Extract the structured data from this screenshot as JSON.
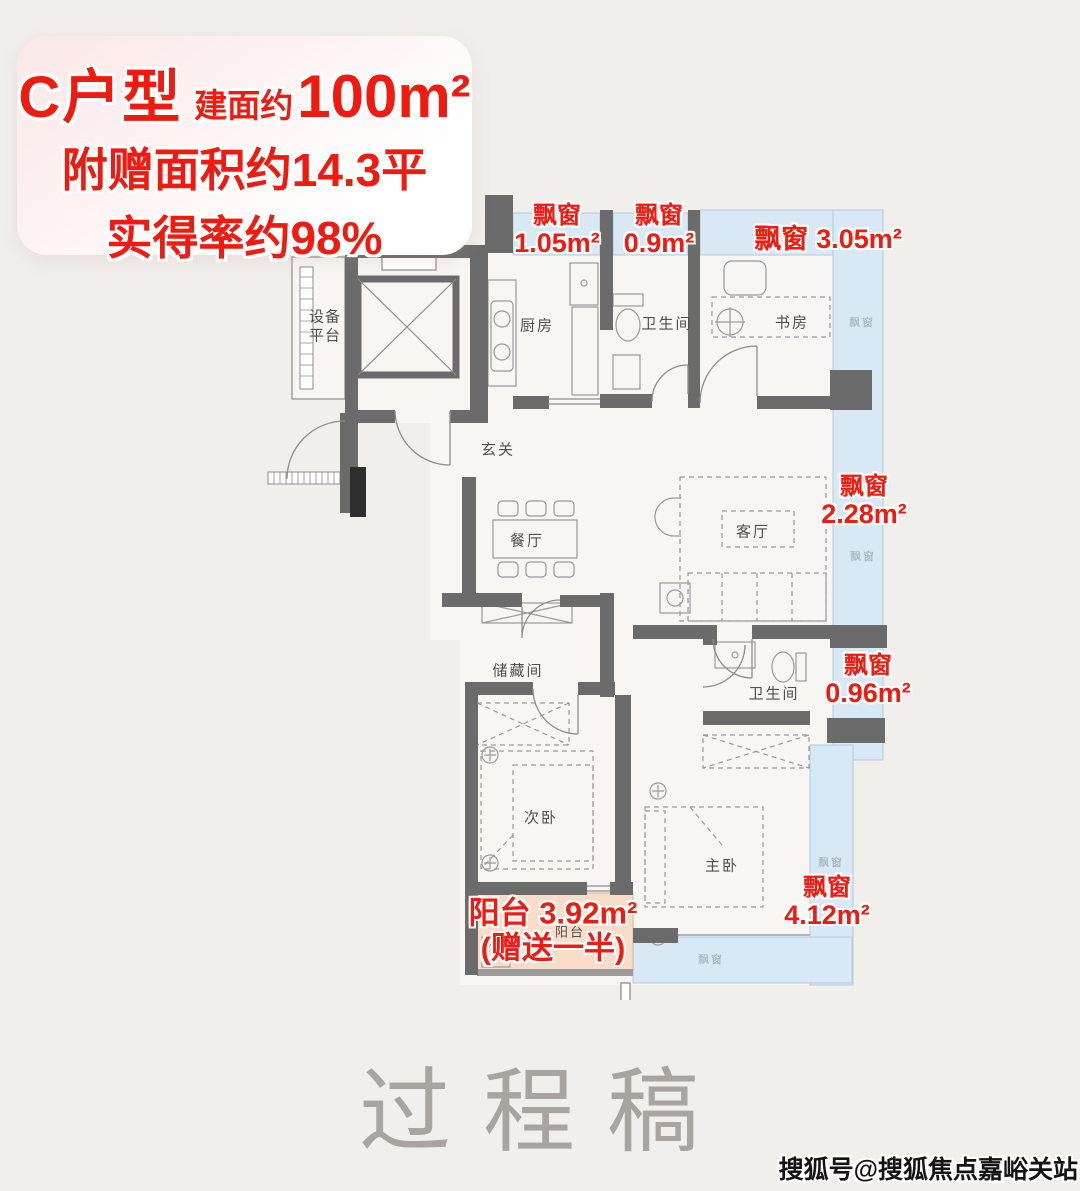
{
  "title_card": {
    "unit": "C户型",
    "area_label": "建面约",
    "area_value": "100m²",
    "bonus_line": "附赠面积约14.3平",
    "rate_line": "实得率约98%"
  },
  "bay_windows": [
    {
      "label": "飘窗",
      "area": "1.05m²"
    },
    {
      "label": "飘窗",
      "area": "0.9m²"
    },
    {
      "label": "飘窗",
      "area": "3.05m²"
    },
    {
      "label": "飘窗",
      "area": "2.28m²"
    },
    {
      "label": "飘窗",
      "area": "0.96m²"
    },
    {
      "label": "飘窗",
      "area": "4.12m²"
    }
  ],
  "balcony_note": {
    "line1": "阳台 3.92m²",
    "line2": "(赠送一半)"
  },
  "rooms": {
    "equipment_platform_1": "设备",
    "equipment_platform_2": "平台",
    "kitchen": "厨房",
    "bathroom_top": "卫生间",
    "study": "书房",
    "foyer": "玄关",
    "dining": "餐厅",
    "living": "客厅",
    "storage": "储藏间",
    "bathroom_bottom": "卫生间",
    "second_bedroom": "次卧",
    "master_bedroom": "主卧",
    "balcony": "阳台",
    "bay_window": "飘窗"
  },
  "watermark": "过程稿",
  "credit": "搜狐号@搜狐焦点嘉峪关站",
  "colors": {
    "accent_red": "#ee1b11",
    "bay_window_blue": "#d8e8f4",
    "balcony_orange": "#f9ddc8",
    "wall_gray": "#6b6b6b",
    "background": "#f1efec"
  }
}
